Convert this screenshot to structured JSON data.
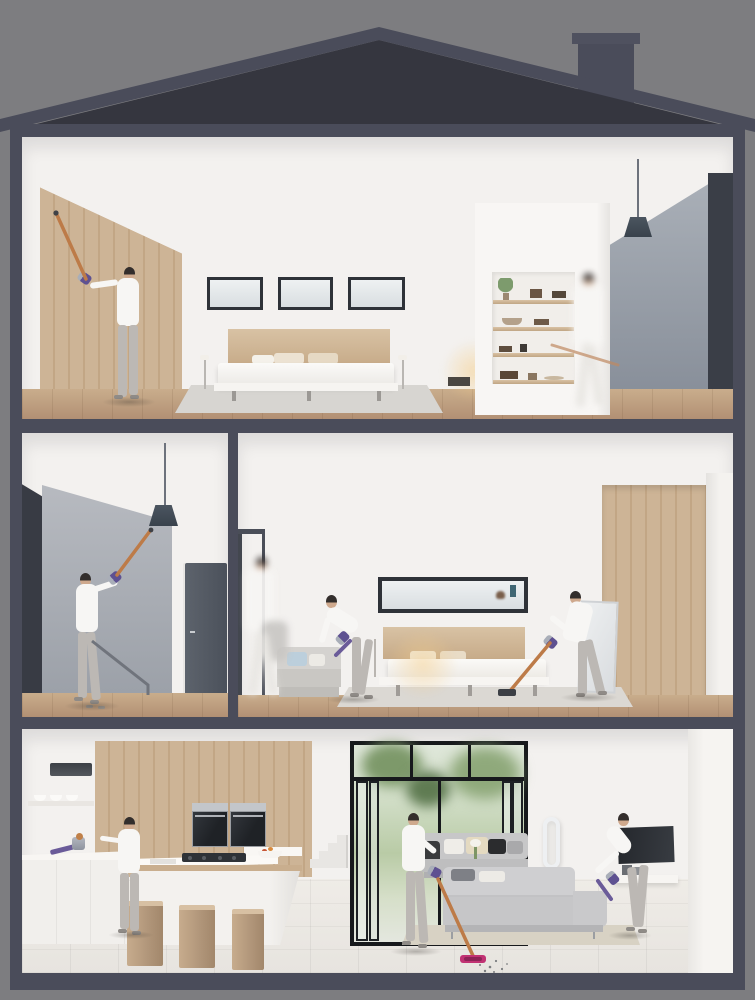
{
  "page": {
    "title": "Cutaway house illustration: people cleaning every floor with cordless vacuums"
  },
  "palette": {
    "bg": "#7d7d80",
    "frame": "#4a4c5a",
    "roof": "#35363f",
    "wall": "#f3f1ef",
    "graywall": "#a8adb5",
    "darkpanel": "#3a3e47",
    "doorgray": "#565c66",
    "sofa": "#c7c7c8",
    "rug": "#d8d2c4",
    "copper": "#bd7b48",
    "purple": "#5e5191",
    "nickel": "#a9aeb8",
    "fuchsia": "#c13273",
    "garden": "#b9cba6",
    "steel": "#c3c6ca",
    "appdark": "#26292e",
    "skin": "#cfa98d",
    "hair": "#332e2c",
    "legging": "#bcb8b4",
    "white": "#f7f6f4"
  },
  "scene": {
    "rooms": [
      {
        "id": "top-bedroom",
        "label": "Top floor bedroom: woman reaching high on wood feature wall with cordless stick vacuum; three clerestory windows; low double bed"
      },
      {
        "id": "top-landing",
        "label": "Top floor landing: recessed shelving niche, pendant lamp, blurred person walking with vacuum wand"
      },
      {
        "id": "middle-stairwell",
        "label": "Middle floor stairwell: woman cleaning around pendant light with cordless vacuum; stair railing and gray door"
      },
      {
        "id": "middle-bedroom",
        "label": "Middle floor bedroom: woman vacuuming sofa, woman vacuuming floor, blurred person passing doorway; long window over bed; wood wardrobe"
      },
      {
        "id": "kitchen",
        "label": "Ground floor kitchen: handheld vacuum resting on counter beside woman; island with three wood stools; double wall ovens"
      },
      {
        "id": "living-room",
        "label": "Ground floor living room: woman vacuuming debris from tiles, woman vacuuming sofa; folding garden doors, tower fan, wall TV"
      }
    ],
    "people_count": 9,
    "equipment": [
      "cordless-stick-vacuum",
      "handheld-vacuum",
      "tower-fan"
    ]
  }
}
